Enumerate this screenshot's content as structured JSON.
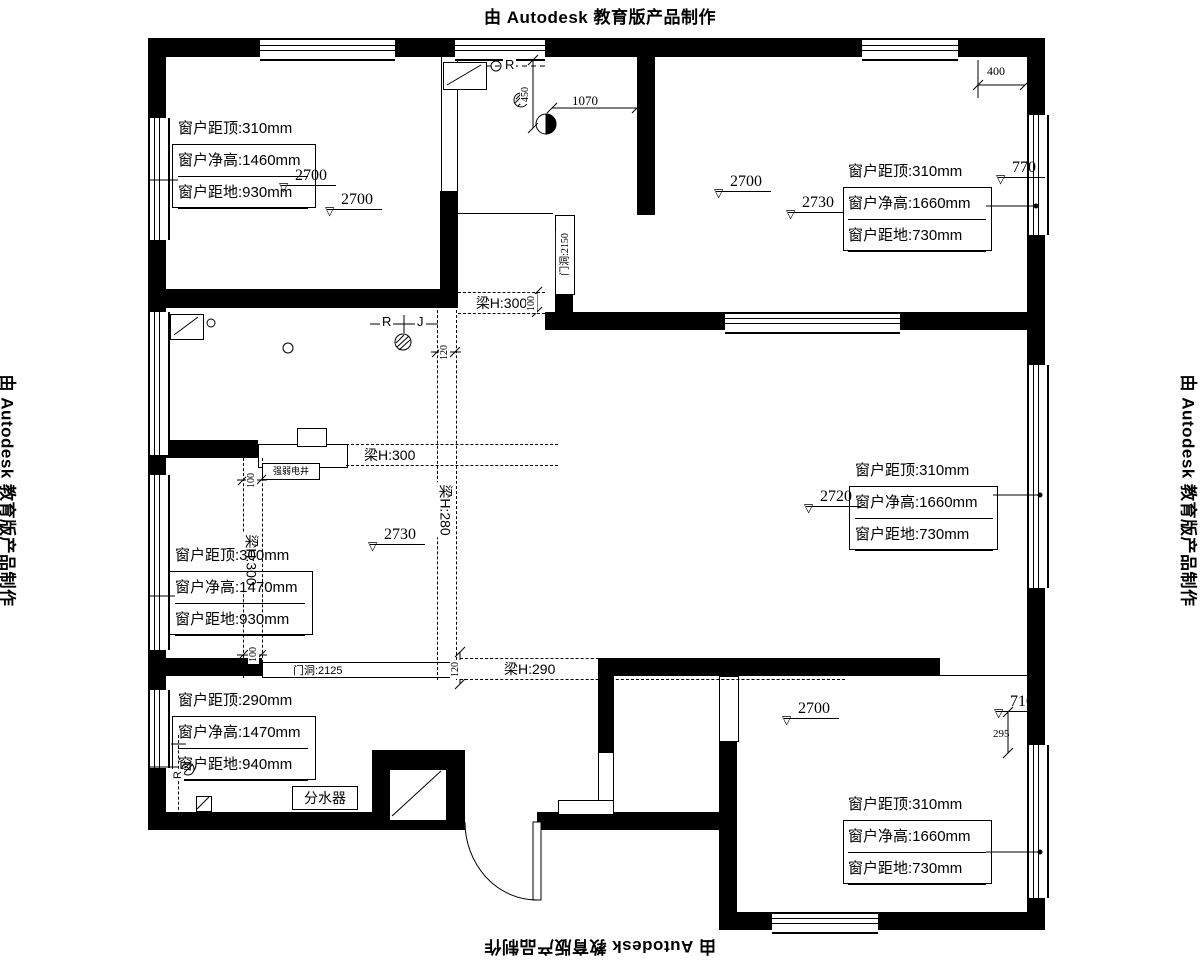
{
  "stamp": {
    "text": "由 Autodesk 教育版产品制作"
  },
  "icons": {
    "level_triangle": "▽"
  },
  "window_labels": {
    "top_left": [
      "窗户距顶:310mm",
      "窗户净高:1460mm",
      "窗户距地:930mm"
    ],
    "top_right": [
      "窗户距顶:310mm",
      "窗户净高:1660mm",
      "窗户距地:730mm"
    ],
    "mid_left": [
      "窗户距顶:300mm",
      "窗户净高:1470mm",
      "窗户距地:930mm"
    ],
    "mid_right": [
      "窗户距顶:310mm",
      "窗户净高:1660mm",
      "窗户距地:730mm"
    ],
    "bottom_left": [
      "窗户距顶:290mm",
      "窗户净高:1470mm",
      "窗户距地:940mm"
    ],
    "bottom_right": [
      "窗户距顶:310mm",
      "窗户净高:1660mm",
      "窗户距地:730mm"
    ]
  },
  "levels": {
    "tl_a": "2700",
    "tl_b": "2700",
    "tr_a": "2700",
    "tr_b": "2730",
    "mid": "2730",
    "right": "2720",
    "bottom": "2700",
    "r770": "770",
    "r710": "710"
  },
  "beams": {
    "hall_top": "梁H:300",
    "hall_mid": "梁H:300",
    "hall_bottom": "梁H:290",
    "vert_left": "梁H:300",
    "vert_right": "梁H:280"
  },
  "dims": {
    "kitchen_width": "1070",
    "top_right": "400",
    "kitchen_height": "450",
    "right_bottom": "295",
    "beam_top": "100",
    "beam_vert": "120",
    "beam_left": "100",
    "beam_left_bottom": "100",
    "beam_bottom": "120"
  },
  "openings": {
    "kitchen_door": "门洞:2150",
    "bedroom_door": "门洞:2125"
  },
  "annotations": {
    "manifold": "分水器",
    "shaft_label": "强弱电井",
    "riser_r": "R",
    "riser_j": "J",
    "riser_kitchen": "R",
    "riser_entry": "R"
  }
}
